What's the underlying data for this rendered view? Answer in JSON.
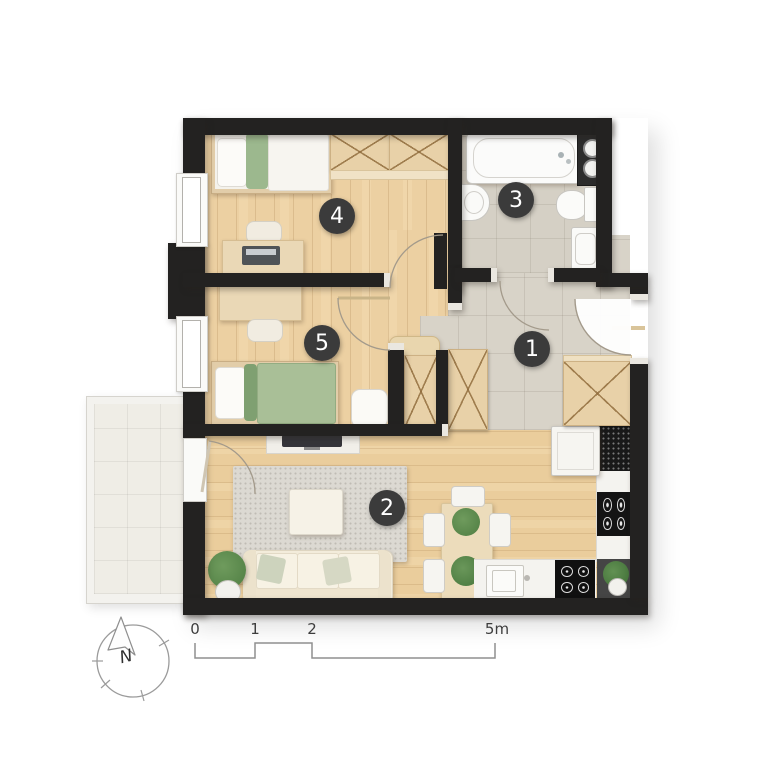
{
  "page": {
    "type": "apartment floor plan",
    "background": "#ffffff"
  },
  "rooms": [
    {
      "number": "1",
      "name": "hallway"
    },
    {
      "number": "2",
      "name": "living room"
    },
    {
      "number": "3",
      "name": "bathroom"
    },
    {
      "number": "4",
      "name": "bedroom"
    },
    {
      "number": "5",
      "name": "bedroom"
    }
  ],
  "scale_bar": {
    "tick_labels": [
      "0",
      "1",
      "2",
      "5m"
    ]
  },
  "compass": {
    "north_label": "N"
  },
  "colors": {
    "wall": "#232221",
    "wood_floor": "#ecd0a2",
    "hall_tile": "#d8d3c8",
    "bathroom_tile": "#d5d0c5",
    "balcony_tile": "#efede6",
    "badge_background": "#3b3b3b",
    "badge_text": "#ffffff",
    "bed_green": "#a9bf97",
    "plant_green": "#4e7d42"
  }
}
